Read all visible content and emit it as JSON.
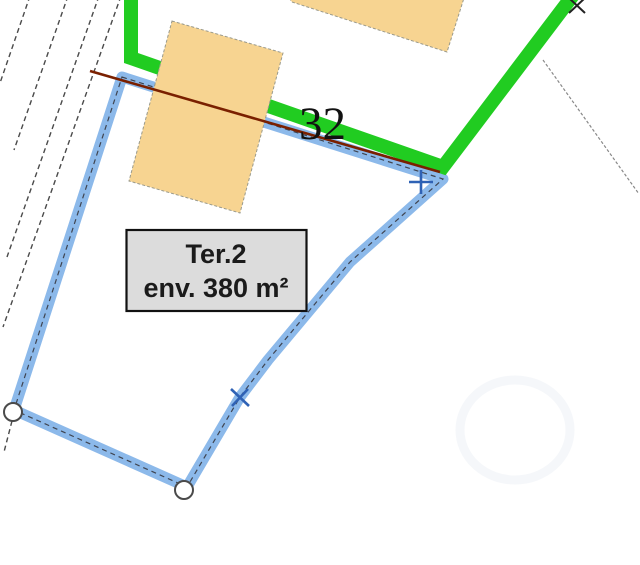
{
  "plan": {
    "parcel_number": "32",
    "area_label": {
      "title": "Ter.2",
      "area": "env. 380 m²"
    },
    "colors": {
      "parcel_outline_blue": "#8CB9EA",
      "parcel_dash": "#3F4450",
      "boundary_green": "#21CC21",
      "boundary_red": "#7A2000",
      "building_fill": "#F7D491",
      "building_edge": "#9A9A8C",
      "label_box_bg": "#DCDCDC",
      "label_box_border": "#111111",
      "marker_blue": "#2F62B5",
      "marker_dark": "#222222",
      "road_line": "#4A4A4A",
      "thin_boundary": "#888888"
    }
  }
}
